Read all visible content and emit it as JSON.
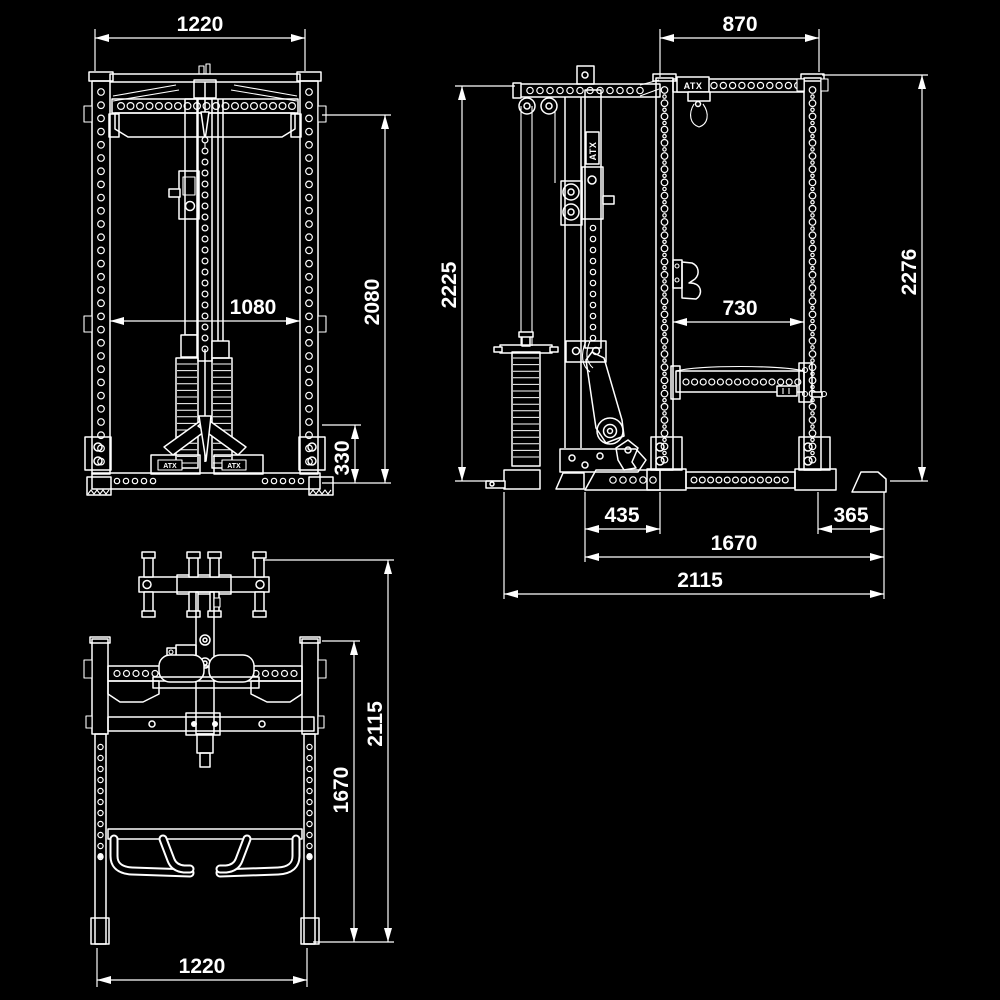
{
  "drawing": {
    "background_color": "#000000",
    "line_color": "#ffffff",
    "brand": "ATX",
    "views": {
      "front": {
        "label": "front-view",
        "dimensions": {
          "outer_width": "1220",
          "inner_width": "1080",
          "frame_height": "2080",
          "base_height": "330"
        }
      },
      "side": {
        "label": "side-view",
        "dimensions": {
          "rack_depth_top": "870",
          "tower_height": "2225",
          "frame_height": "2276",
          "inner_depth": "730",
          "front_foot_depth": "435",
          "rear_foot_depth": "365",
          "foot_span": "1670",
          "overall_depth": "2115"
        }
      },
      "plan": {
        "label": "top-view",
        "dimensions": {
          "outer_width": "1220",
          "frame_length": "1670",
          "overall_length": "2115"
        }
      }
    }
  }
}
